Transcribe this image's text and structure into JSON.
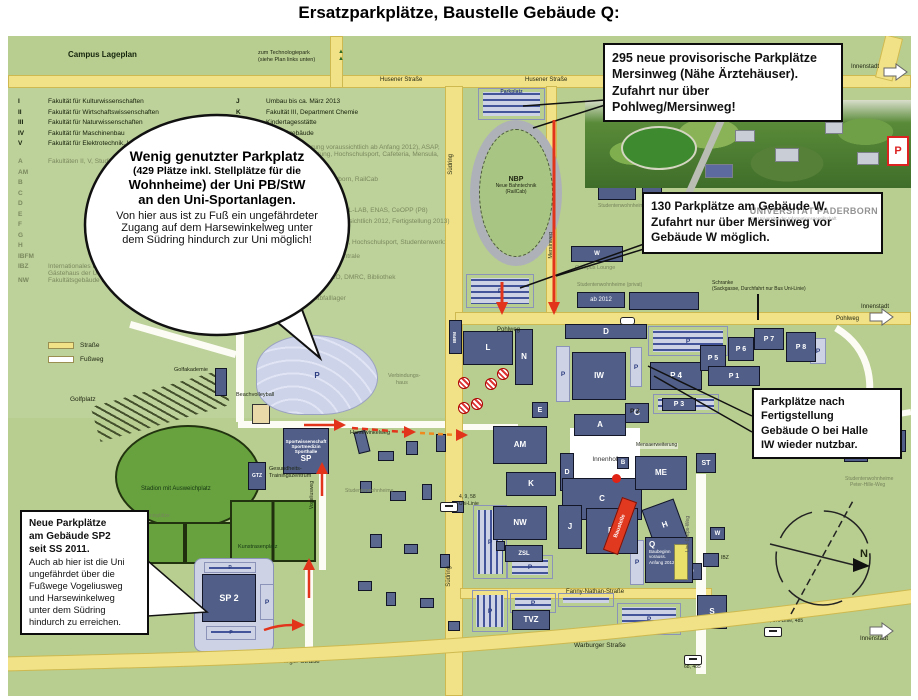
{
  "title": "Ersatzparkplätze, Baustelle Gebäude Q:",
  "plan": {
    "heading": "Campus Lageplan",
    "tech1": "zum Technologiepark",
    "tech2": "(siehe Plan links unten)",
    "strasse": "Straße",
    "fussweg": "Fußweg"
  },
  "legend": {
    "l1": [
      {
        "code": "I",
        "label": "Fakultät für Kulturwissenschaften"
      },
      {
        "code": "II",
        "label": "Fakultät für Wirtschaftswissenschaften"
      },
      {
        "code": "III",
        "label": "Fakultät für Naturwissenschaften"
      },
      {
        "code": "IV",
        "label": "Fakultät für Maschinenbau"
      },
      {
        "code": "V",
        "label": "Fakultät für Elektrotechnik, Informatik und Mathematik"
      }
    ],
    "l2": [
      {
        "code": "A",
        "label": "Fakultäten II, V, Studiobühne, Presselabor, IMT"
      },
      {
        "code": "AM",
        "label": ""
      },
      {
        "code": "B",
        "label": ""
      },
      {
        "code": "C",
        "label": ""
      },
      {
        "code": "D",
        "label": ""
      },
      {
        "code": "E",
        "label": ""
      },
      {
        "code": "F",
        "label": ""
      },
      {
        "code": "G",
        "label": ""
      },
      {
        "code": "H",
        "label": ""
      },
      {
        "code": "IBFM",
        "label": ""
      },
      {
        "code": "IBZ",
        "label": "Internationales Begegnungszentrum, Jenny-Aloni-Haus, Gästehaus der Uni"
      },
      {
        "code": "NW",
        "label": "Fakultätsgebäude Naturwissenschaften"
      }
    ],
    "r1": [
      {
        "code": "J",
        "label": "Umbau bis ca. März 2013"
      },
      {
        "code": "K",
        "label": "Fakultät III, Department Chemie"
      },
      {
        "code": "Kita",
        "label": "Kindertagesstätte"
      },
      {
        "code": "L",
        "label": "Hörsaalgebäude"
      }
    ],
    "r2": [
      {
        "code": "ME",
        "label": "Mensa (Erweiterung voraussichtlich ab Anfang 2012), ASAP, Studierendenberatung, Hochschulsport, Cafeteria, Mensula, Snackbar"
      },
      {
        "code": "N",
        "label": "IMT, WPR, GamesLab"
      },
      {
        "code": "NBP",
        "label": "Neue Bahntechnik Paderborn, RailCab"
      },
      {
        "code": "O",
        "label": "Versuchsanlage"
      },
      {
        "code": "P",
        "label": "Fakultät V, Informatik, PC²"
      },
      {
        "code": "P1-9",
        "label": "Fakultät II, IV, V, PLAZ (P9), L-LAB, ENAS, CeOPP (P8)"
      },
      {
        "code": "Q",
        "label": "Fakultät I (Baubeginn voraussichtlich 2012, Fertigstellung 2013)"
      },
      {
        "code": "S",
        "label": "Fakultät I (Kunstsilo)"
      },
      {
        "code": "SP",
        "label": "Sportanlagen, Golfakademie, Hochschulsport, Studentenwerk: Service Point, Wohnheime"
      },
      {
        "code": "TVZ",
        "label": "Technische Versorgungszentrale"
      },
      {
        "code": "W",
        "label": "International Office"
      },
      {
        "code": "W",
        "label": "Fakultät I, II, IV, UNESCO, DMRC, Bibliothek"
      },
      {
        "code": "ZD",
        "label": "Poststelle, Druckerei"
      },
      {
        "code": "ZSL",
        "label": "Zentrales Sonderabfalllager"
      }
    ]
  },
  "callouts": {
    "c295": {
      "lines": [
        {
          "t": "295 neue provisorische Parkplätze"
        },
        {
          "t": "Mersinweg (Nähe Ärztehäuser)."
        },
        {
          "t": "Zufahrt nur über Pohlweg/Mersinweg!"
        }
      ]
    },
    "c130": {
      "lines": [
        {
          "t": "130 Parkplätze am Gebäude W."
        },
        {
          "t": "Zufahrt nur über Mersinweg vor"
        },
        {
          "t": "Gebäude W möglich."
        }
      ]
    },
    "cO": {
      "lines": [
        {
          "t": "Parkplätze nach"
        },
        {
          "t": "Fertigstellung"
        },
        {
          "t": "Gebäude O bei Halle"
        },
        {
          "t": "IW wieder nutzbar."
        }
      ]
    },
    "cSP2": {
      "strong": [
        {
          "t": "Neue Parkplätze"
        },
        {
          "t": "am Gebäude SP2"
        },
        {
          "t": "seit SS 2011."
        }
      ],
      "body": [
        {
          "t": "Auch ab hier ist die Uni"
        },
        {
          "t": "ungefährdet über die"
        },
        {
          "t": "Fußwege Vogeliusweg"
        },
        {
          "t": "und Harsewinkelweg"
        },
        {
          "t": "unter dem Südring"
        },
        {
          "t": "hindurch zu erreichen."
        }
      ]
    },
    "bubble": {
      "title": "Wenig genutzter Parkplatz",
      "sub": "(429 Plätze inkl. Stellplätze für die",
      "sub2": "Wohnheime) der Uni PB/StW",
      "sub3": "an den Uni-Sportanlagen.",
      "body": "Von hier aus ist zu Fuß ein ungefährdeter Zugang auf dem Harsewinkelweg unter dem Südring hindurch zur Uni möglich!"
    }
  },
  "logo": {
    "l1": "UNIVERSITÄT PADERBORN",
    "l2": "Die Universität der Informationsgesellschaft"
  },
  "streets": {
    "husener": "Husener Straße",
    "suedring": "Südring",
    "pohlweg": "Pohlweg",
    "mersinweg": "Mersinweg",
    "warburger": "Warburger Straße",
    "fanny": "Fanny-Nathan-Straße",
    "harsewinkelweg": "Harsewinkelweg",
    "vogeliusweg": "Vogeliusweg",
    "liese": "Lise-Dreps-Weg",
    "peterhille": "Peter-Hille-Weg",
    "innenstadt": "Innenstadt"
  },
  "labels": {
    "p": "P",
    "p2": "P 2",
    "parkplatz": "Parkplatz",
    "nbp": "NBP",
    "nbp2": "Neue Bahntechnik",
    "nbp3": "(RailCab)",
    "stadion": "Stadion mit Ausweichplatz",
    "golfplatz": "Golfplatz",
    "golfakademie": "Golfakademie",
    "beach": "Beachvolleyball",
    "kunstrasen": "Kunstrasenplatz",
    "tennis": "Tennisplätze",
    "sport1": "Sportwissenschaft",
    "sport2": "Sportmedizin",
    "sport3": "Sporthalle",
    "gtz": "GTZ",
    "gtz1": "Gesundheits-",
    "gtz2": "Trainingszentrum",
    "campuslounge": "Campus Lounge",
    "wohnheime": "Studentenwohnheime",
    "wohnheimePrivat": "Studentenwohnheime (privat)",
    "ab2012": "ab 2012",
    "wohnheimePH1": "Studentenwohnheime",
    "wohnheimePH2": "Peter-Hille-Weg",
    "verbind1": "Verbindungs-",
    "verbind2": "haus",
    "mensaerw": "Mensaerweiterung",
    "schranke1": "Schranke",
    "schranke2": "(Sackgasse, Durchfahrt nur Bus Uni-Linie)",
    "innenhof": "Innenhof",
    "baustelle": "Baustelle",
    "q1": "Baubeginn",
    "q2": "vorauss.",
    "q3": "Anfang 2012",
    "bus1a": "4, 9, 58",
    "bus1b": "Uni-Linie",
    "bus2": "68, Uni-Linie, 485",
    "bus3": "68, 485",
    "north": "N"
  },
  "buildings": {
    "IBFM": "IBFM",
    "L": "L",
    "N": "N",
    "D1": "D",
    "IW": "IW",
    "AM": "AM",
    "E": "E",
    "A": "A",
    "G": "G",
    "B": "B",
    "D2": "D",
    "C": "C",
    "K": "K",
    "J": "J",
    "BI": "BI",
    "H": "H",
    "ME": "ME",
    "ST": "ST",
    "ZD": "ZD",
    "Q": "Q",
    "NW": "NW",
    "ZSL": "ZSL",
    "TVZ": "TVZ",
    "S": "S",
    "W1": "W",
    "W2": "W",
    "IBZ": "IBZ",
    "SP": "SP",
    "SP2": "SP 2",
    "P1": "P 1",
    "P3": "P 3",
    "P4": "P 4",
    "P5": "P 5",
    "P6": "P 6",
    "P7": "P 7",
    "P8": "P 8"
  },
  "colors": {
    "map_green": "#b8cd90",
    "road_yellow": "#f2e287",
    "building_blue": "#515f88",
    "parking_gray": "#cdd3e4",
    "field_green": "#67a23f",
    "arrow_red": "#e2331b",
    "callout_border": "#0d0d0d"
  }
}
